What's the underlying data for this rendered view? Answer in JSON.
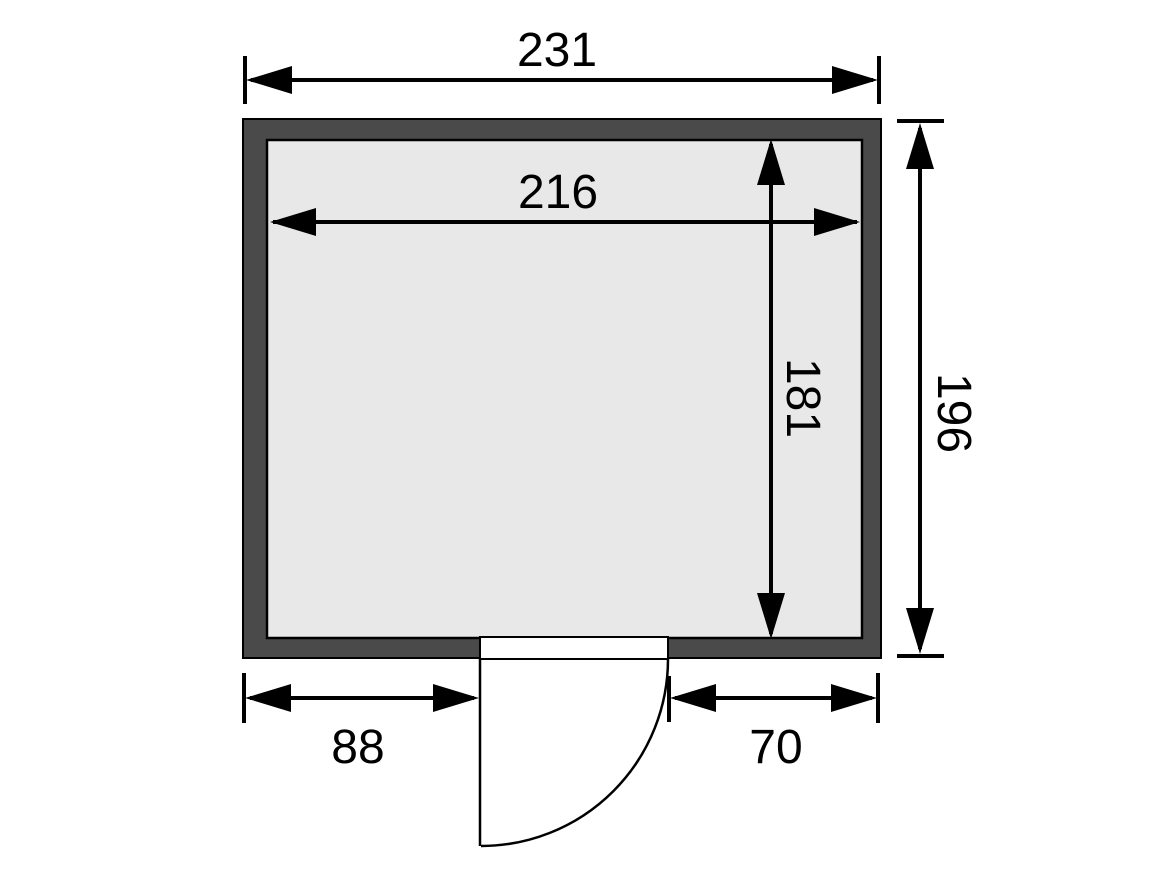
{
  "diagram": {
    "type": "floor-plan-top-view",
    "labels": {
      "outer_width": "231",
      "inner_width": "216",
      "inner_depth": "181",
      "outer_depth": "196",
      "door_left_offset": "88",
      "door_right_offset": "70"
    },
    "values": {
      "outer_width": 231,
      "inner_width": 216,
      "inner_depth": 181,
      "outer_depth": 196,
      "door_left_offset": 88,
      "door_right_offset": 70
    },
    "colors": {
      "wall": "#4a4a4a",
      "floor": "#e8e8e8",
      "door": "#ffffff",
      "line": "#000000",
      "background": "#ffffff"
    }
  }
}
